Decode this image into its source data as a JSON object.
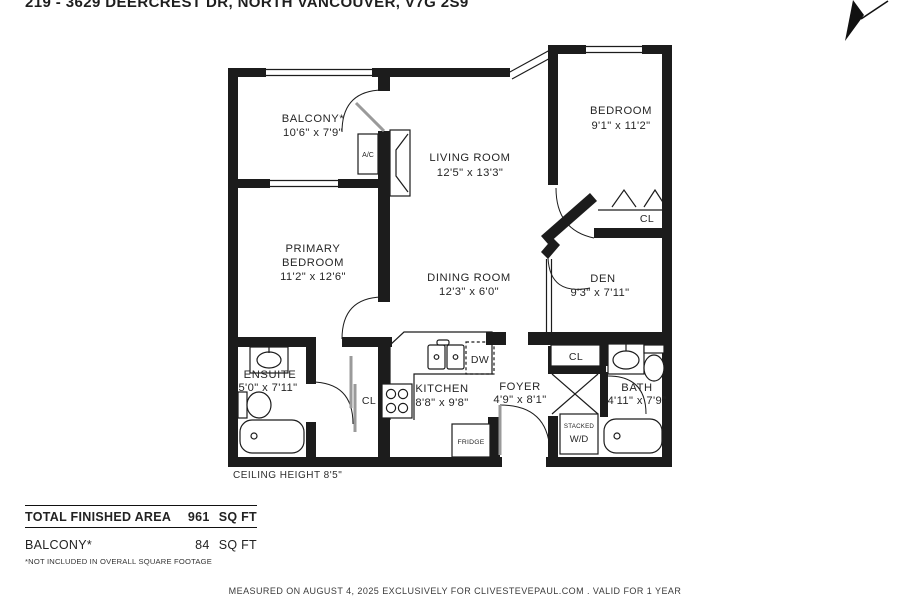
{
  "title": "219 - 3629 DEERCREST DR, NORTH VANCOUVER, V7G 2S9",
  "rooms": {
    "balcony": {
      "name": "BALCONY*",
      "dims": "10'6\" x 7'9\""
    },
    "living": {
      "name": "LIVING ROOM",
      "dims": "12'5\" x 13'3\""
    },
    "bedroom": {
      "name": "BEDROOM",
      "dims": "9'1\" x 11'2\""
    },
    "primary": {
      "name1": "PRIMARY",
      "name2": "BEDROOM",
      "dims": "11'2\" x 12'6\""
    },
    "dining": {
      "name": "DINING ROOM",
      "dims": "12'3\" x 6'0\""
    },
    "den": {
      "name": "DEN",
      "dims": "9'3\" x 7'11\""
    },
    "ensuite": {
      "name": "ENSUITE",
      "dims": "5'0\" x 7'11\""
    },
    "kitchen": {
      "name": "KITCHEN",
      "dims": "8'8\" x 9'8\""
    },
    "foyer": {
      "name": "FOYER",
      "dims": "4'9\" x 8'1\""
    },
    "bath": {
      "name": "BATH",
      "dims": "4'11\" x 7'9\""
    }
  },
  "fixtures": {
    "ac": "A/C",
    "dw": "DW",
    "fridge": "FRIDGE",
    "stacked": "STACKED",
    "wd": "W/D",
    "closet": "CL"
  },
  "ceiling_note": "CEILING HEIGHT 8'5\"",
  "summary": {
    "total_label": "TOTAL FINISHED AREA",
    "total_value": "961",
    "total_unit": "SQ FT",
    "balcony_label": "BALCONY*",
    "balcony_value": "84",
    "balcony_unit": "SQ FT",
    "footnote": "*NOT INCLUDED IN OVERALL SQUARE FOOTAGE"
  },
  "footer": "MEASURED ON AUGUST 4, 2025 EXCLUSIVELY FOR CLIVESTEVEPAUL.COM . VALID FOR 1 YEAR",
  "colors": {
    "wall": "#1c1c1c",
    "text": "#262626"
  }
}
